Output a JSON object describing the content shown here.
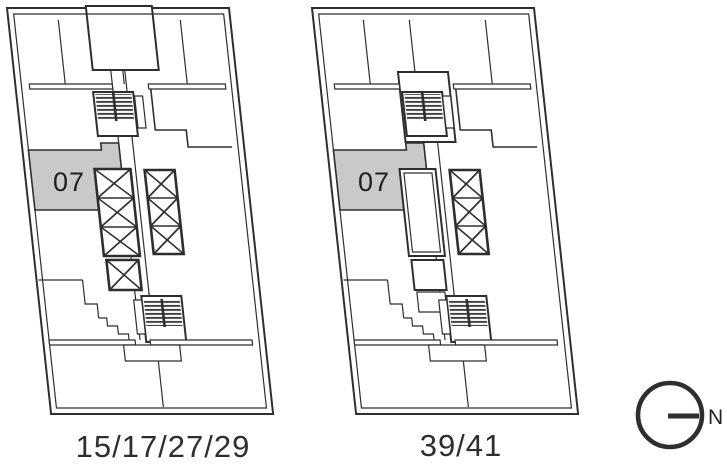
{
  "document": {
    "type": "floorplate-key-plan",
    "background": "#ffffff"
  },
  "plans": [
    {
      "id": "plan-a",
      "unit_label": "07",
      "floors_label": "15/17/27/29",
      "highlighted_unit": "07"
    },
    {
      "id": "plan-b",
      "unit_label": "07",
      "floors_label": "39/41",
      "highlighted_unit": "07"
    }
  ],
  "compass": {
    "label": "N",
    "direction": "right"
  },
  "colors": {
    "line": "#2e2e2e",
    "unit_fill": "#c9c9c9",
    "text": "#2e2e2e"
  }
}
